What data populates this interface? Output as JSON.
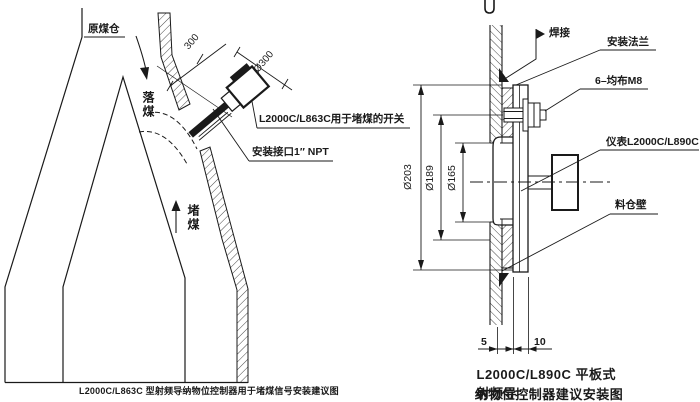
{
  "left_diagram": {
    "bunker_label": "原煤仓",
    "falling_coal_label": "落煤",
    "blocked_coal_label": "堵煤",
    "dim_insertion": "300",
    "dim_diameter": "Ø300",
    "switch_note": "L2000C/L863C用于堵煤的开关",
    "port_note": "安装接口1″ NPT",
    "caption": "L2000C/L863C 型射频导纳物位控制器用于堵煤信号安装建议图"
  },
  "right_diagram": {
    "weld_label": "焊接",
    "flange_label": "安装法兰",
    "bolt_label": "6–均布M8",
    "instrument_label": "仪表L2000C/L890C",
    "wall_label": "料仓壁",
    "dim_flange_od": "Ø203",
    "dim_bolt_circle": "Ø189",
    "dim_opening": "Ø165",
    "dim_gap": "5",
    "dim_thickness": "10",
    "caption_line1": "L2000C/L890C 平板式射频导",
    "caption_line2": "纳物位控制器建议安装图"
  },
  "colors": {
    "ink": "#1a1a1a",
    "background": "#ffffff"
  }
}
